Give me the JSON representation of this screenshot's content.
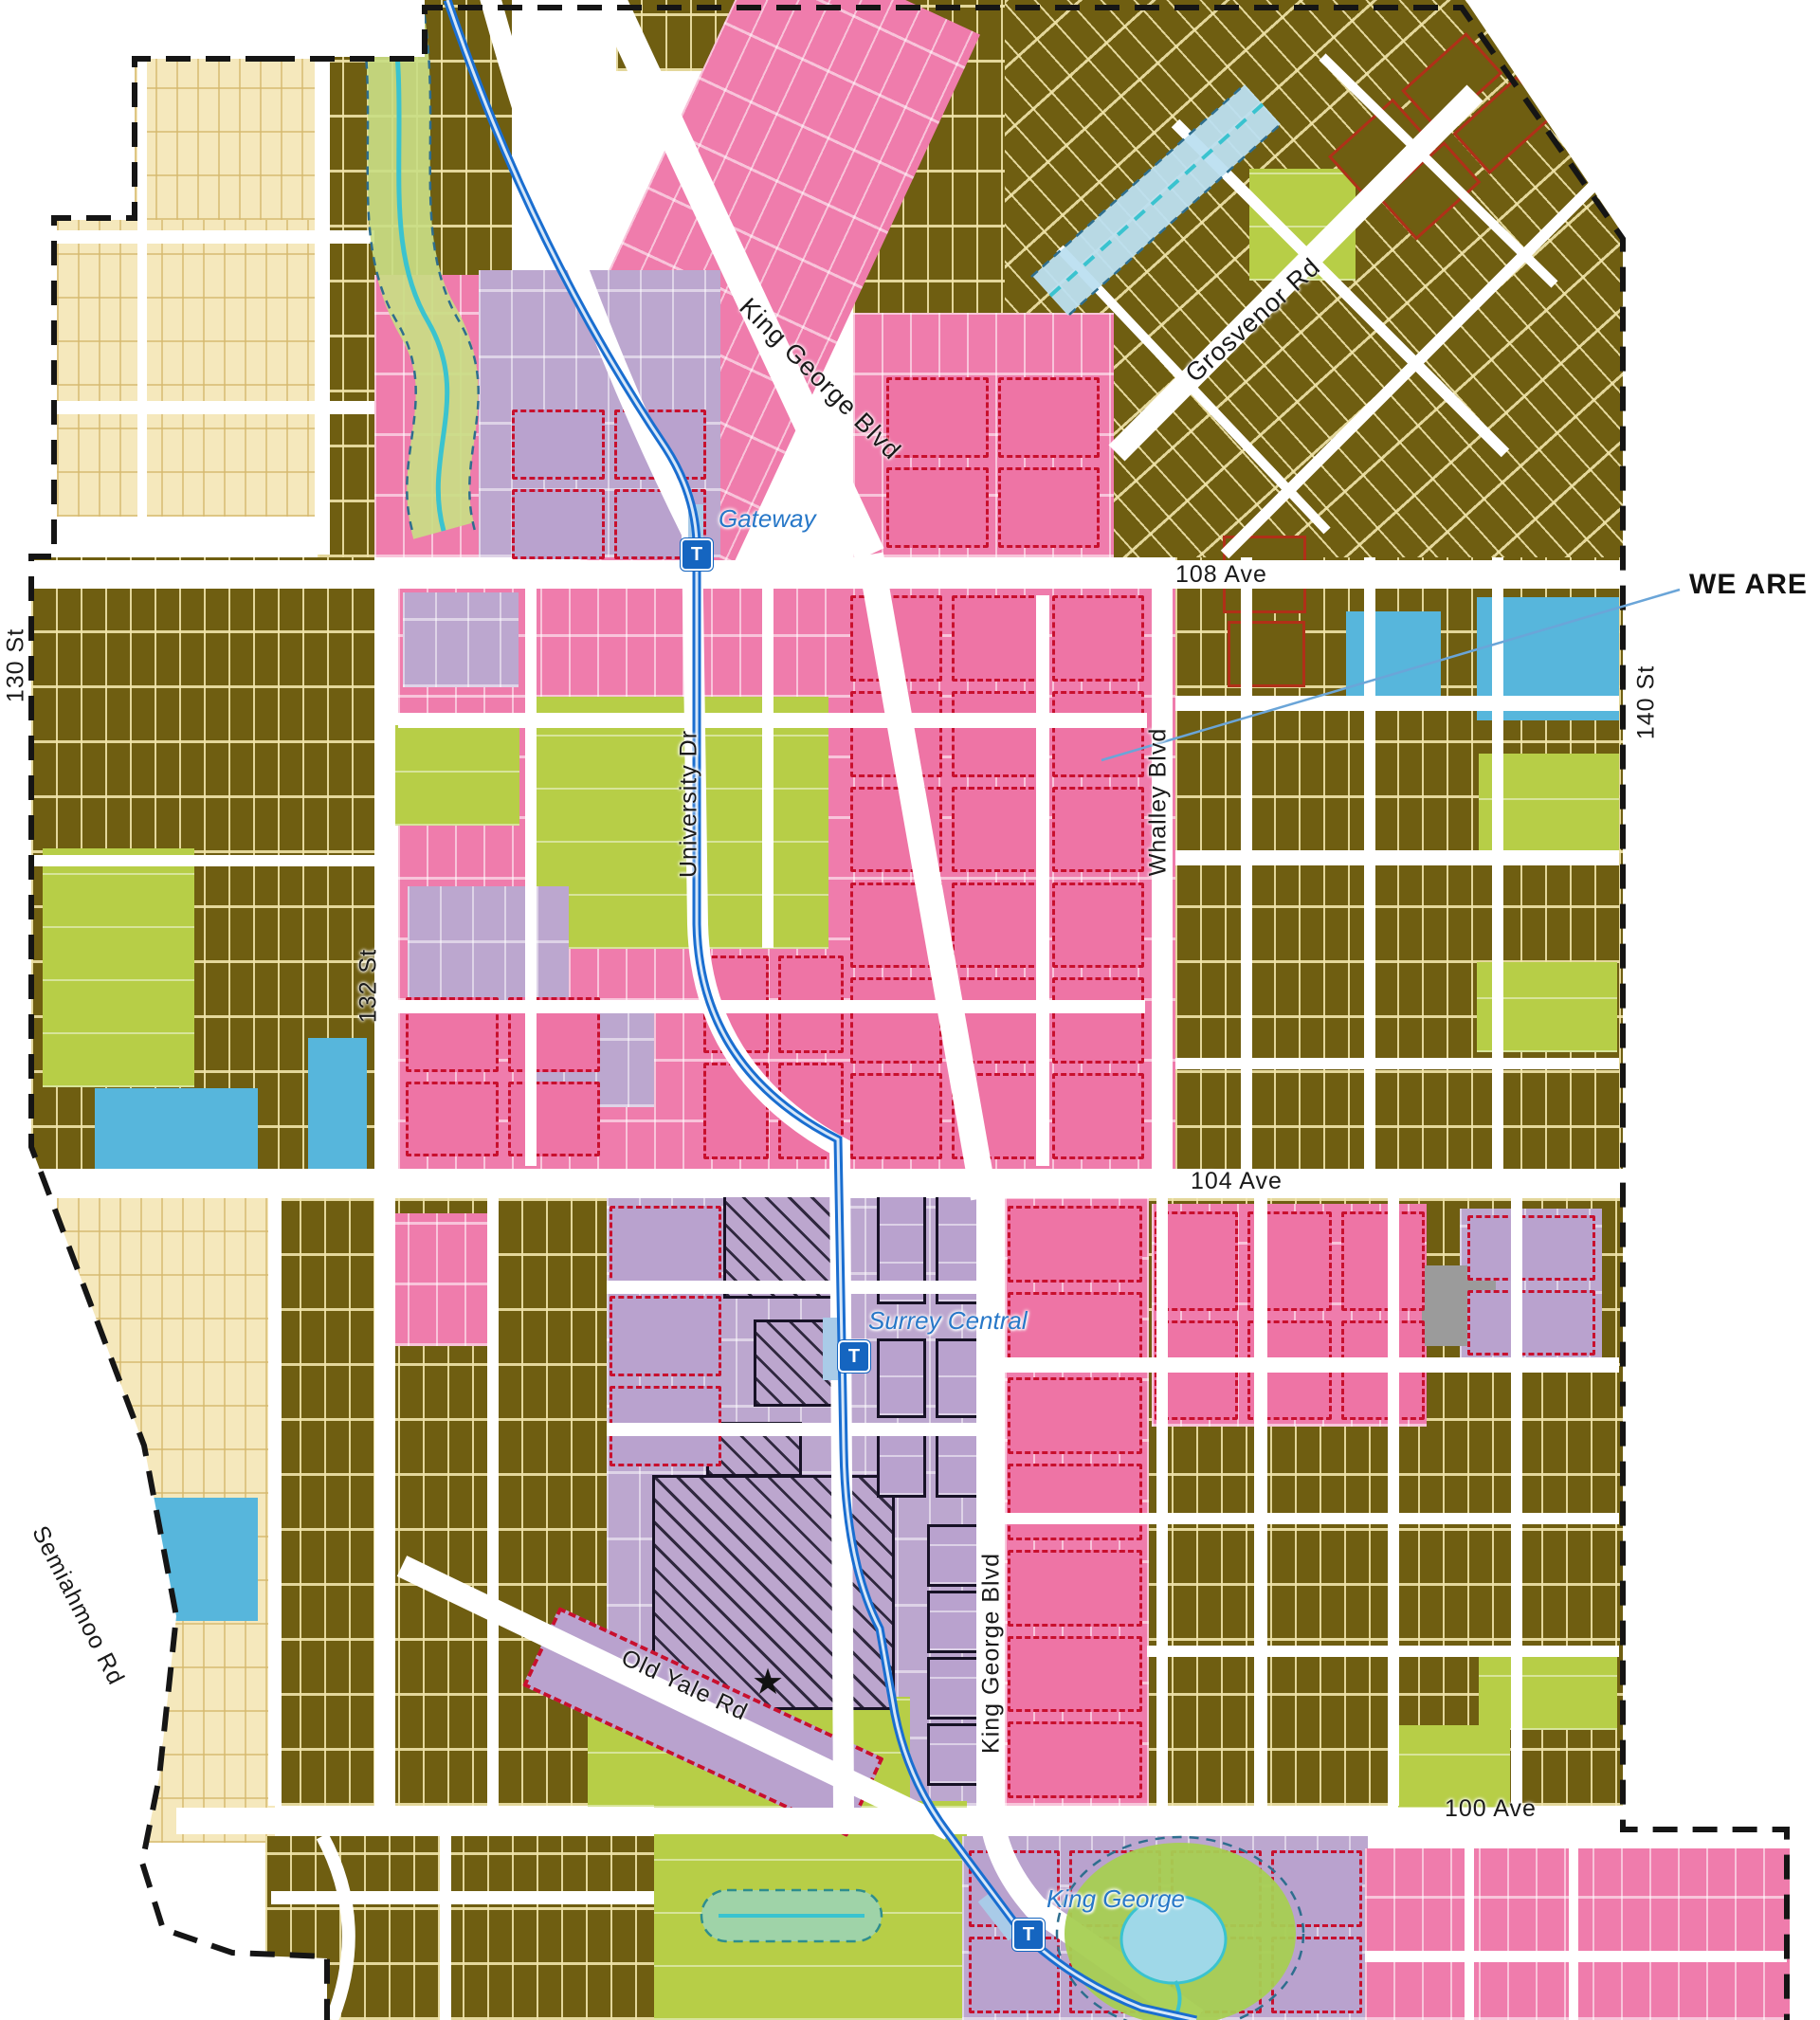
{
  "map": {
    "streets": {
      "king_george_blvd": "King George Blvd",
      "grosvenor_rd": "Grosvenor Rd",
      "ave_108": "108 Ave",
      "ave_104": "104 Ave",
      "ave_100": "100 Ave",
      "st_130": "130 St",
      "st_132": "132 St",
      "st_140": "140 St",
      "university_dr": "University Dr",
      "whalley_blvd": "Whalley Blvd",
      "old_yale_rd": "Old Yale Rd",
      "semiahmoo_rd": "Semiahmoo Rd"
    },
    "stations": {
      "marker_glyph": "T",
      "gateway": "Gateway",
      "surrey_central": "Surrey Central",
      "king_george": "King George"
    },
    "annotation": {
      "we_are": "WE ARE"
    },
    "icons": {
      "location_star": "★"
    },
    "palette": {
      "single_family_olive": "#6F5E11",
      "parcel_line_cream": "#EFE2AE",
      "multifamily_pink": "#EE7CAC",
      "redevelopment_dash_red": "#C8102E",
      "commercial_lavender": "#BCA7CF",
      "park_green": "#B7CE47",
      "institutional_blue": "#57B6DC",
      "suburban_beige": "#F5E8BC",
      "utility_gray": "#9B9B9B",
      "city_centre_outline": "#171226",
      "heritage_red_outline": "#B03018",
      "skytrain_blue": "#1A6ED0",
      "station_box_blue": "#1565C0",
      "station_label_blue": "#2878C8",
      "creek_cyan": "#3AC3CF",
      "environment_outline": "#2E6E8E",
      "plan_boundary_black": "#151515",
      "callout_line_blue": "#6AA5D8"
    }
  }
}
